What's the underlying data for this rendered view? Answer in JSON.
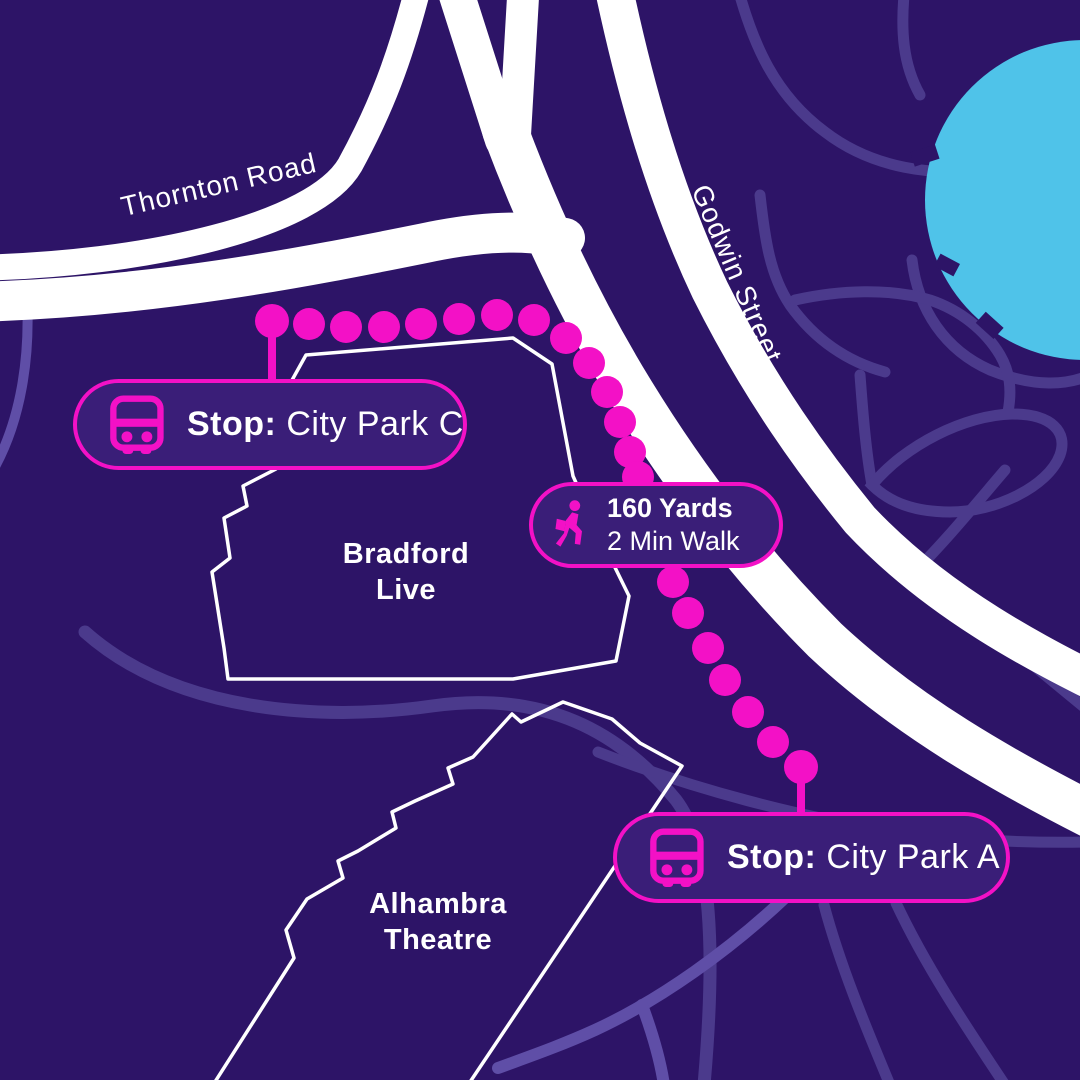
{
  "streets": {
    "thornton": "Thornton Road",
    "godwin": "Godwin Street"
  },
  "buildings": {
    "bradford": {
      "line1": "Bradford",
      "line2": "Live"
    },
    "alhambra": {
      "line1": "Alhambra",
      "line2": "Theatre"
    }
  },
  "stops": {
    "c": {
      "prefix": "Stop:",
      "name": "City Park C"
    },
    "a": {
      "prefix": "Stop:",
      "name": "City Park A"
    }
  },
  "walk_badge": {
    "distance": "160 Yards",
    "duration": "2 Min Walk"
  },
  "icons": {
    "bus": "bus-icon",
    "walker": "walking-person-icon"
  },
  "colors": {
    "background": "#2d1467",
    "road_major": "#ffffff",
    "road_minor": "#4b3a8c",
    "road_minor_light": "#5f4ea7",
    "route_magenta": "#f311c6",
    "water_blue": "#4fc3e9",
    "pill_fill": "#3a1e78",
    "pill_border": "#f311c6",
    "text": "#ffffff"
  }
}
